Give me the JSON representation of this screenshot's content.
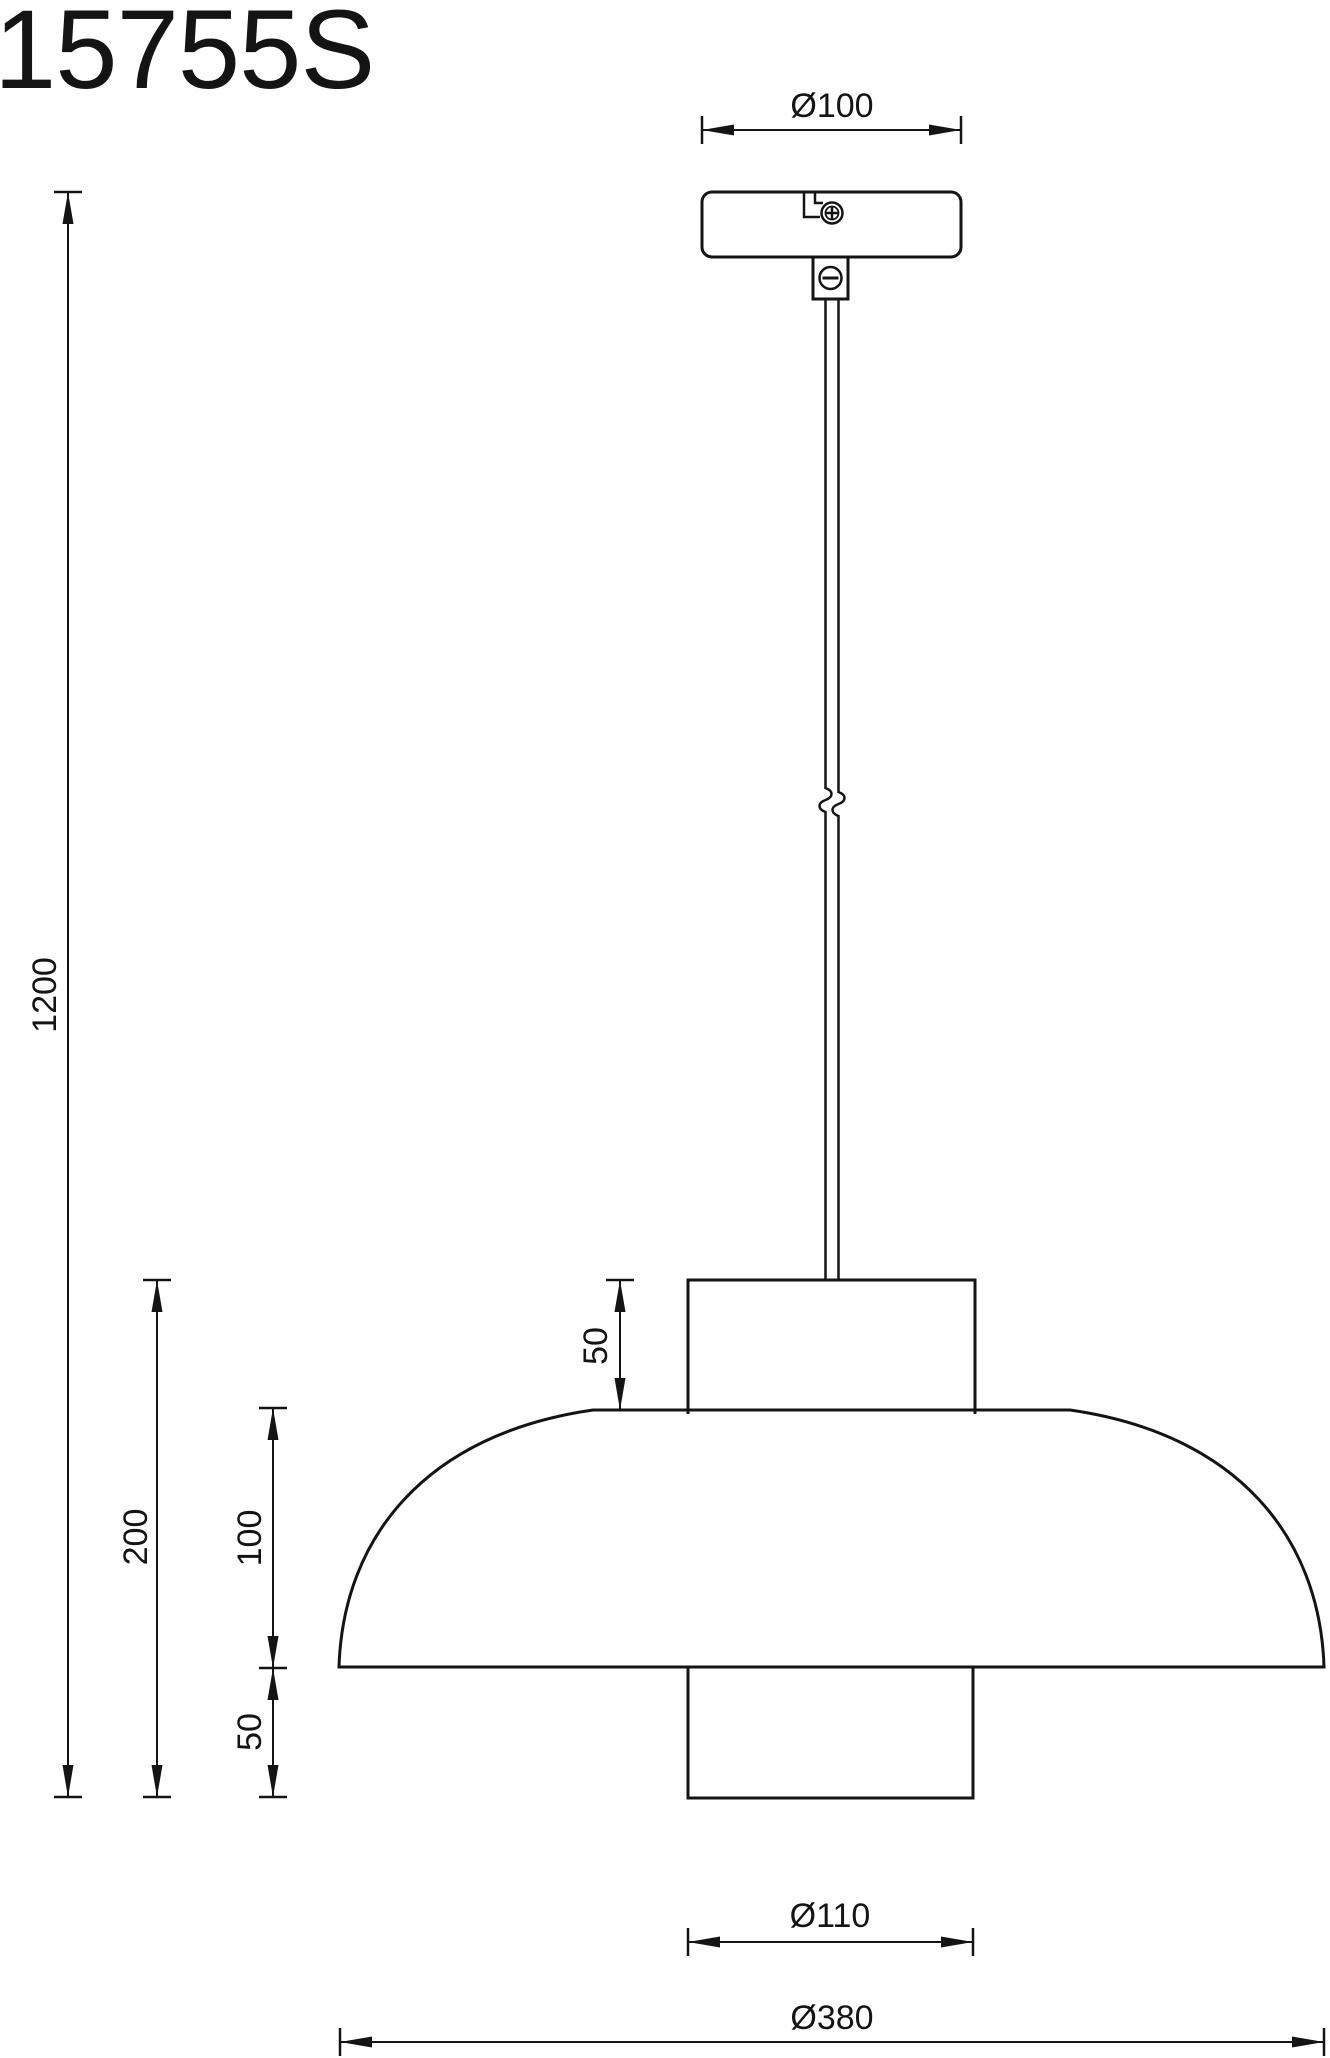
{
  "title": "15755S",
  "drawing_type": "pendant-lamp-dimension-drawing",
  "colors": {
    "line": "#141414",
    "background": "#ffffff"
  },
  "dimensions": {
    "canopy_diameter": "Ø100",
    "suspension_length": "1200",
    "fixture_total_height": "200",
    "shade_dome_height": "100",
    "top_neck_height": "50",
    "bottom_cylinder_height": "50",
    "bottom_cylinder_diameter": "Ø110",
    "shade_diameter": "Ø380"
  }
}
